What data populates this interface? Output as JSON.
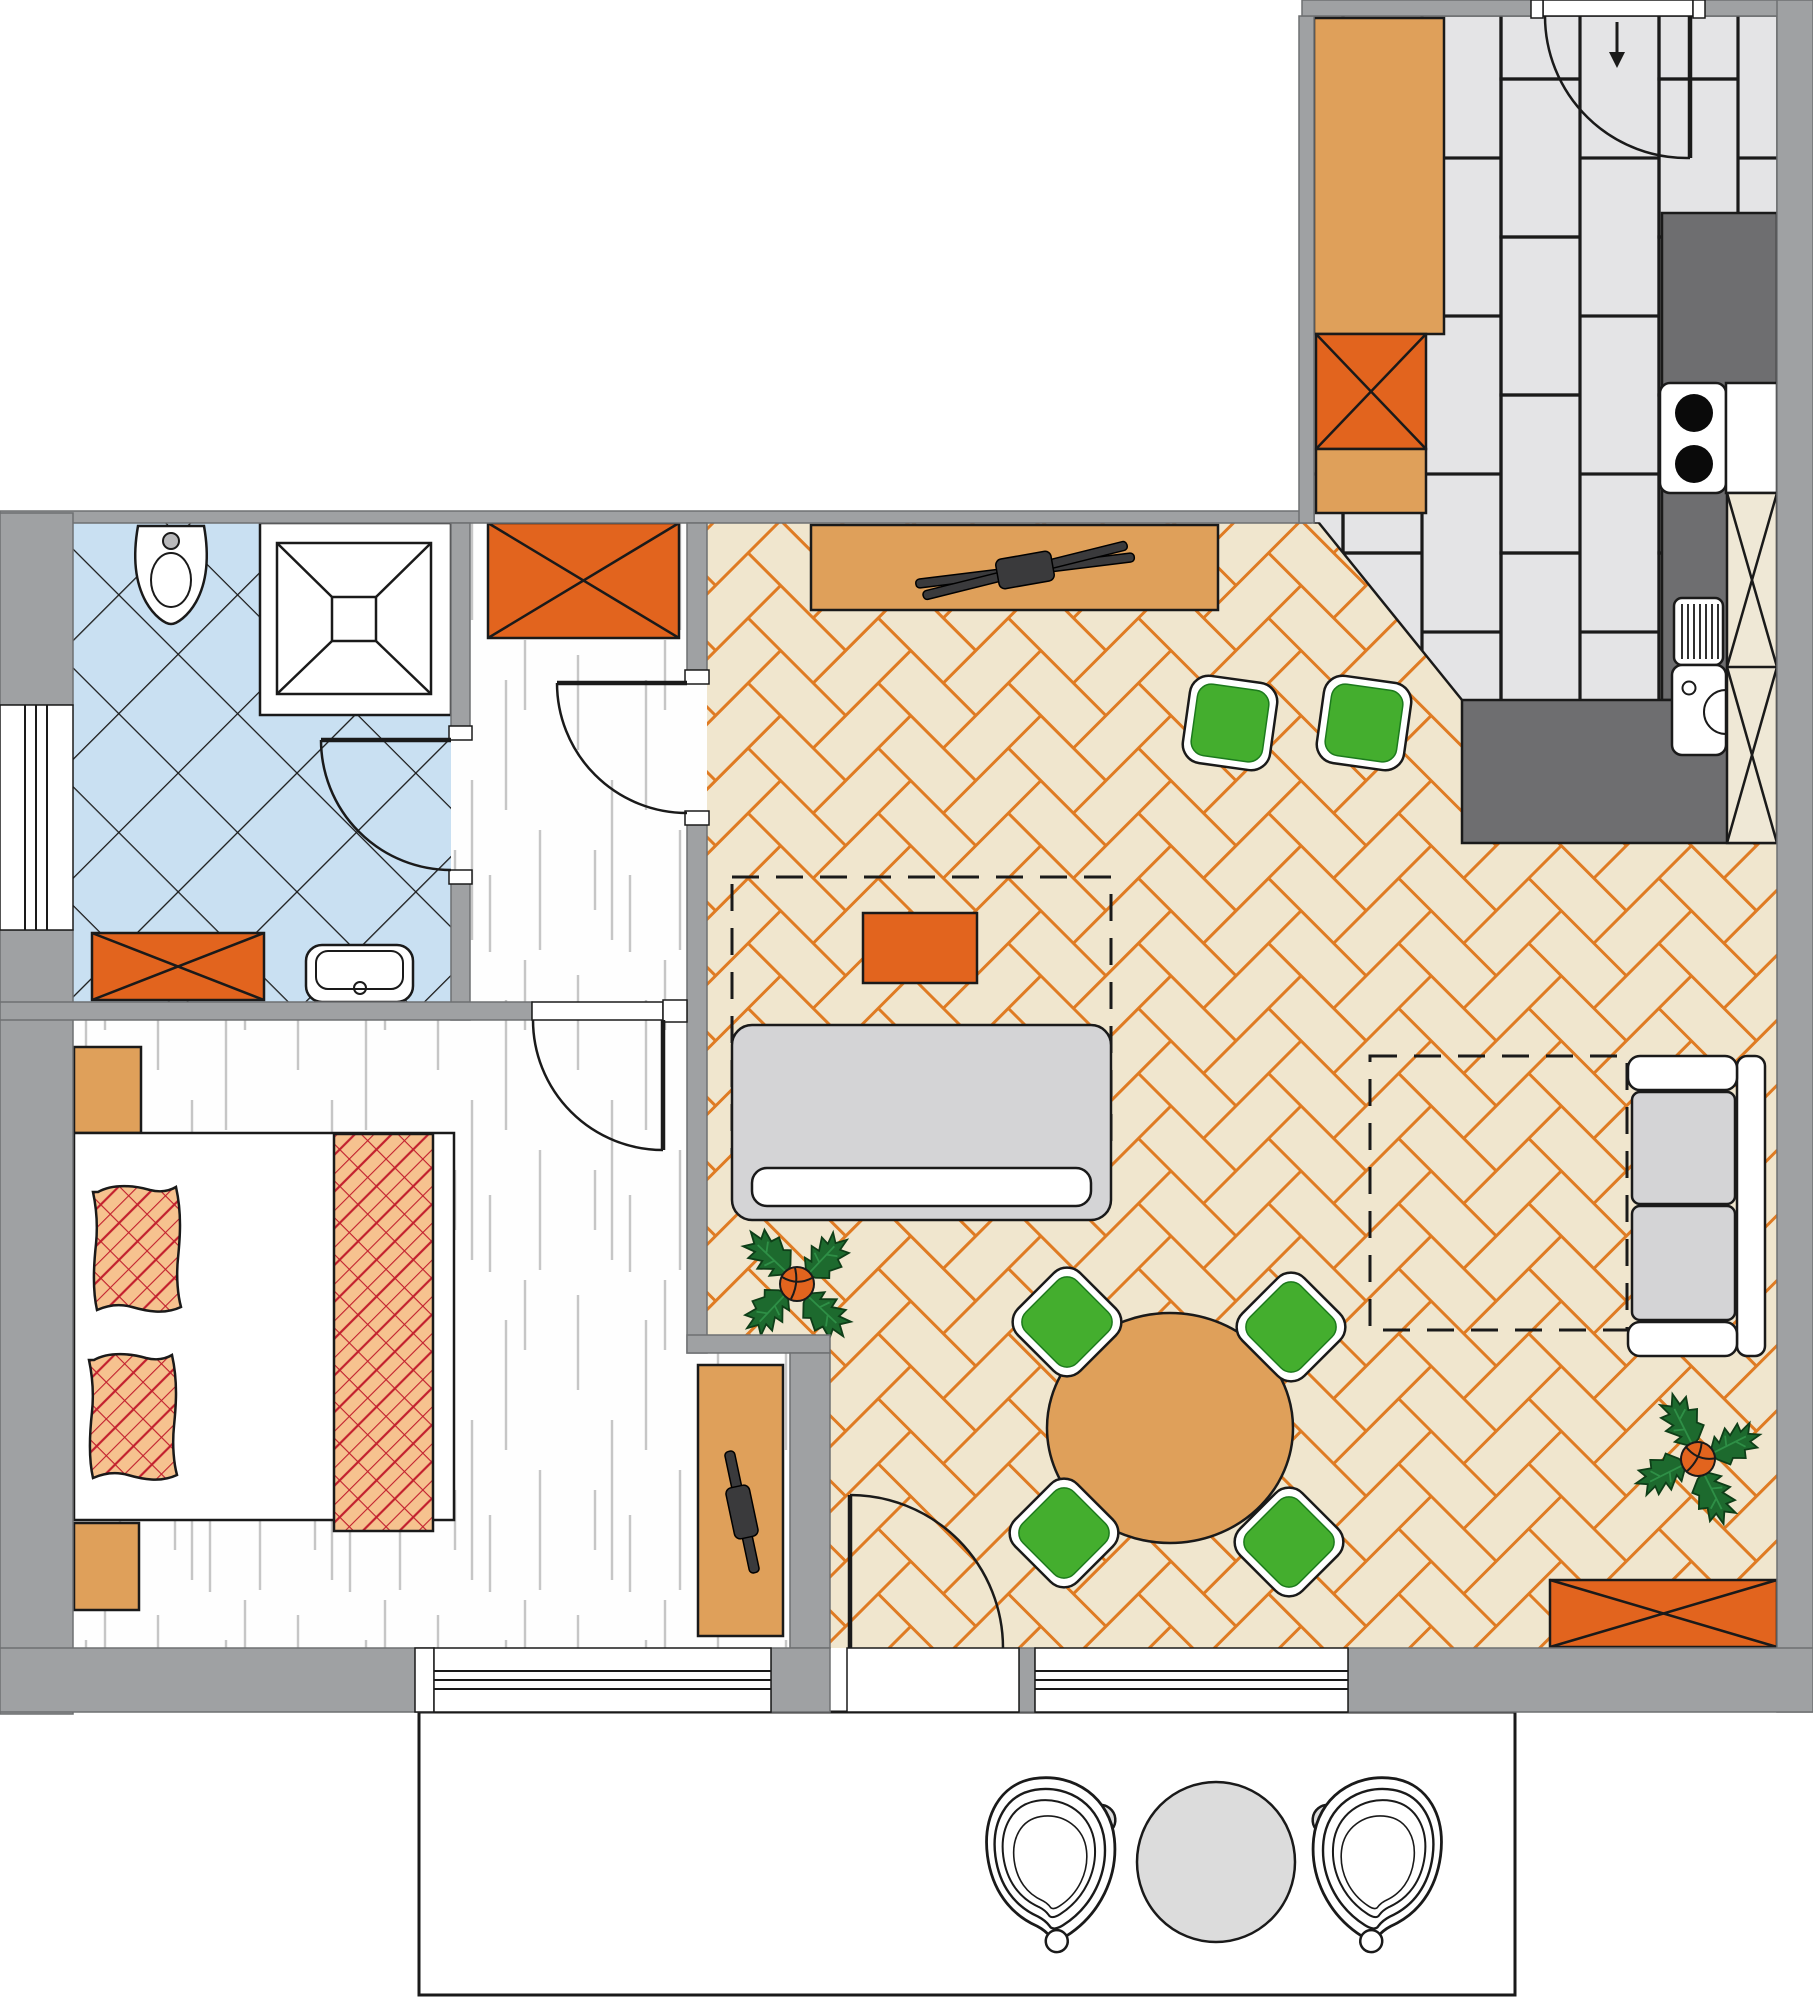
{
  "plan": {
    "type": "apartment-floor-plan",
    "rooms": [
      "kitchen",
      "bathroom",
      "hallway",
      "bedroom",
      "living-room",
      "balcony"
    ],
    "symbols": {
      "kitchen": [
        "counter",
        "crossed-base-cabinet",
        "base-cabinet",
        "stove-two-burners",
        "worktop",
        "radiator",
        "sink-unit",
        "tall-cabinet-crossed",
        "entry-door",
        "entry-arrow"
      ],
      "bathroom": [
        "toilet",
        "shower",
        "washbasin",
        "crossed-cabinet",
        "door-swing",
        "window"
      ],
      "hallway": [
        "crossed-wardrobe",
        "door-swing"
      ],
      "bedroom": [
        "bed",
        "blanket",
        "pillow",
        "pillow",
        "nightstand",
        "nightstand",
        "tv-board",
        "tv",
        "door-swing",
        "window"
      ],
      "living-room": [
        "sideboard",
        "tv",
        "desk-dashed-zone",
        "desk",
        "day-bed",
        "duvet",
        "plant",
        "plant",
        "dining-table",
        "dining-chair x4",
        "stool x2",
        "sofa",
        "rug-dashed",
        "crossed-sideboard",
        "balcony-door-swing",
        "window"
      ],
      "balcony": [
        "shell-chair",
        "round-table",
        "shell-chair"
      ]
    }
  },
  "palette": {
    "wall": "#9FA1A3",
    "wallEdge": "#6E7072",
    "line": "#1A1A1A",
    "parquetBg": "#F0E6CE",
    "parquetLine": "#DF7B23",
    "kitchenTileBg": "#E4E4E6",
    "bathTileBg": "#C9E0F2",
    "woodBg": "#FEFEFE",
    "woodStreak": "#C6C6C6",
    "tan": "#DFA05A",
    "orange": "#E2641E",
    "cream": "#EFE8D6",
    "crossBg": "#F6C28F",
    "crossLine": "#C2202E",
    "green": "#44AE2E",
    "greenEdge": "#1C7A1C",
    "leafGreen": "#1D6A2E",
    "leafEdge": "#0E3E18",
    "counter": "#6E6E70",
    "grayFurn": "#D4D4D6",
    "balconyGray": "#DCDCDC",
    "dark": "#3A3A3C",
    "buttonGray": "#B9B9BB"
  }
}
